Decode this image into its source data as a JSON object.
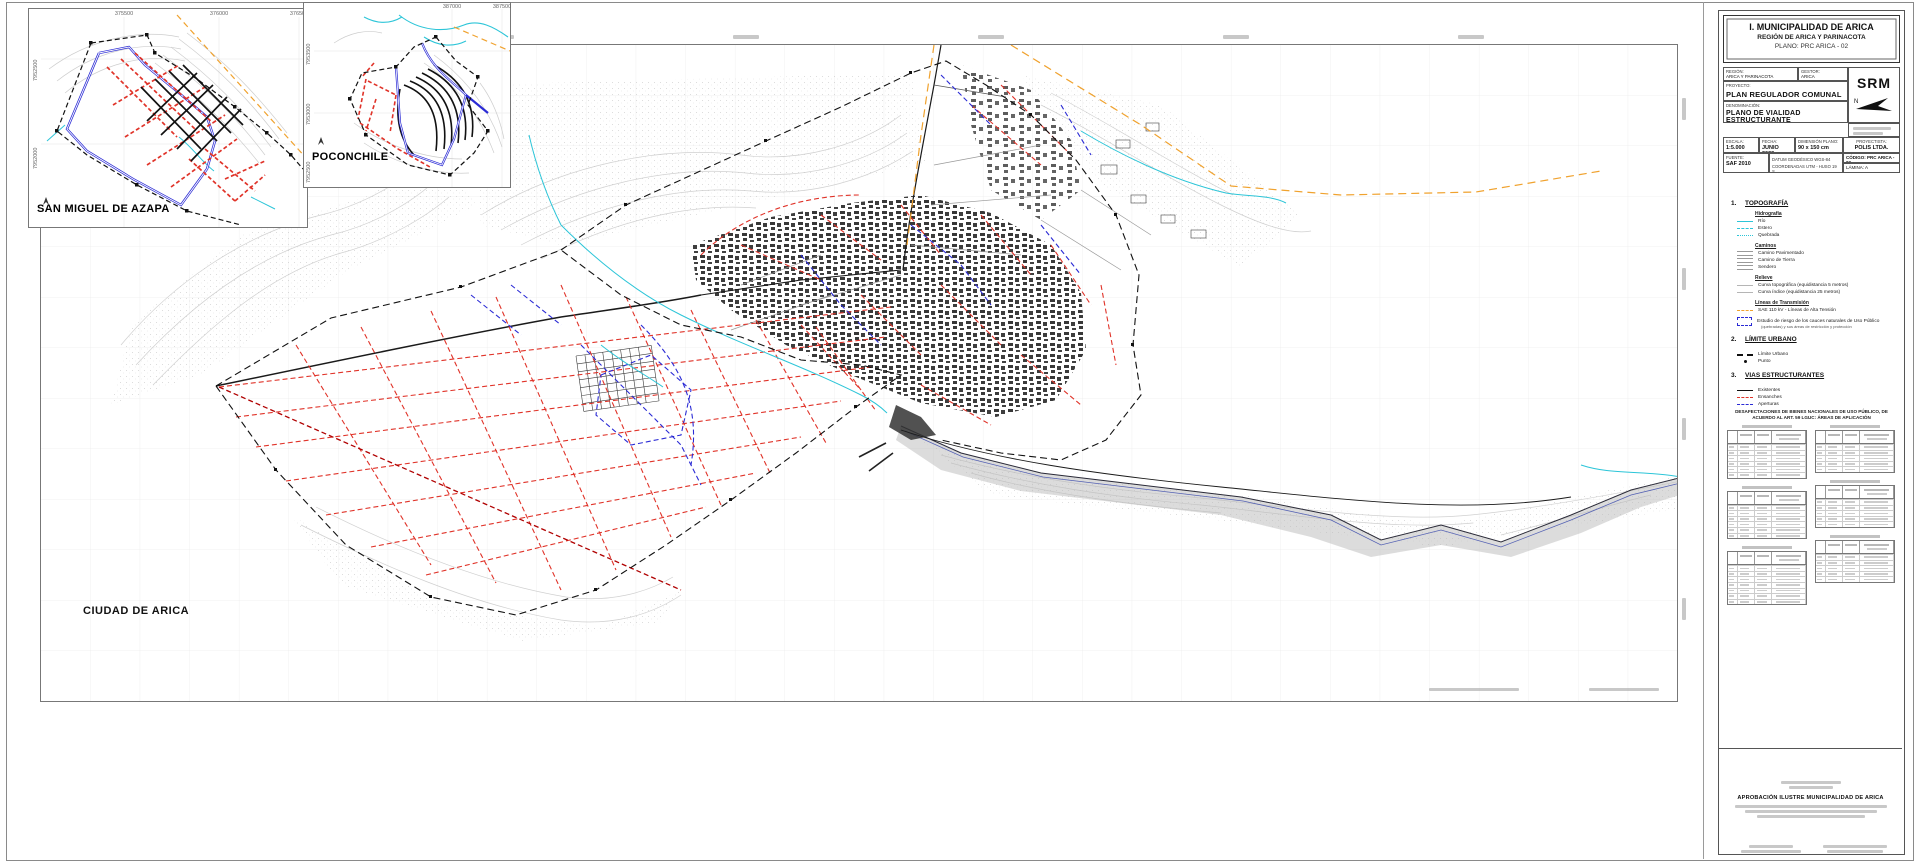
{
  "document": {
    "map_label": "CIUDAD DE ARICA",
    "insets": {
      "san_miguel": {
        "title": "SAN MIGUEL DE AZAPA",
        "x_labels": [
          "375500",
          "376000",
          "376500"
        ],
        "y_labels": [
          "7952500",
          "7952000"
        ]
      },
      "poconchile": {
        "title": "POCONCHILE",
        "x_labels": [
          "387000",
          "387500"
        ],
        "y_labels": [
          "7953500",
          "7953000",
          "7952500"
        ]
      }
    }
  },
  "title_block": {
    "org": "I. MUNICIPALIDAD DE ARICA",
    "region_line": "REGIÓN DE ARICA Y PARINACOTA",
    "plano_line": "PLANO: PRC ARICA - 02",
    "region_cell_label": "REGIÓN:",
    "region_cell": "ARICA Y PARINACOTA",
    "gestor_cell_label": "GESTOR:",
    "gestor_cell": "ARICA",
    "proyecto_label": "PROYECTO:",
    "proyecto": "PLAN REGULADOR COMUNAL DE ARICA",
    "denominacion_label": "DENOMINACIÓN:",
    "denominacion": "PLANO DE VIALIDAD ESTRUCTURANTE",
    "logo_text": "SRM",
    "escala_label": "ESCALA:",
    "escala": "1:5.000",
    "fecha_label": "FECHA:",
    "fecha": "JUNIO 2022",
    "dimension_label": "DIMENSIÓN PLANO:",
    "dimension": "90 x 150 cm",
    "proyectista_label": "PROYECTISTA:",
    "proyectista": "POLIS LTDA.",
    "fuente_label": "FUENTE:",
    "fuente": "SAF 2010",
    "datum_line1": "DATUM GEODÉSICO WGS-84",
    "datum_line2": "COORDENADAS UTM - HUSO 19 S",
    "codigo": "CÓDIGO: PRC ARICA - 02",
    "lamina": "LÁMINA: A"
  },
  "legend": {
    "sections": [
      {
        "num": "1.",
        "title": "TOPOGRAFÍA",
        "groups": [
          {
            "header": "Hidrografía",
            "items": [
              {
                "swatch": "cyan-solid",
                "label": "Río"
              },
              {
                "swatch": "cyan-dash",
                "label": "Estero"
              },
              {
                "swatch": "cyan-dot",
                "label": "Quebrada"
              }
            ]
          },
          {
            "header": "Caminos",
            "items": [
              {
                "swatch": "road",
                "label": "Camino Pavimentado"
              },
              {
                "swatch": "road",
                "label": "Camino de Tierra"
              },
              {
                "swatch": "road",
                "label": "Sendero"
              }
            ]
          },
          {
            "header": "Relieve",
            "items": [
              {
                "swatch": "gray-thin",
                "label": "Curva topográfica (equidistancia 5 metros)"
              },
              {
                "swatch": "gray-thin",
                "label": "Curva índice (equidistancia 25 metros)"
              }
            ]
          },
          {
            "header": "Líneas de Transmisión",
            "items": [
              {
                "swatch": "orange-dash",
                "label": "SAE 110 kV - Líneas de Alta Tensión"
              }
            ]
          },
          {
            "header": null,
            "items": [
              {
                "swatch": "blue-rect",
                "label": "Estudio de riesgo de los cauces naturales de Uso Público",
                "sub": "(quebradas) y sus áreas de restricción y protección"
              }
            ]
          }
        ]
      },
      {
        "num": "2.",
        "title": "LÍMITE URBANO",
        "groups": [
          {
            "header": null,
            "items": [
              {
                "swatch": "limit",
                "label": "Límite Urbano"
              },
              {
                "swatch": "dot",
                "label": "Punto"
              }
            ]
          }
        ]
      },
      {
        "num": "3.",
        "title": "VIAS ESTRUCTURANTES",
        "groups": [
          {
            "header": null,
            "items": [
              {
                "swatch": "black-solid",
                "label": "Existentes"
              },
              {
                "swatch": "red-dash",
                "label": "Ensanches"
              },
              {
                "swatch": "blue-dash",
                "label": "Aperturas"
              }
            ]
          }
        ]
      }
    ]
  },
  "tables": {
    "title_line1": "DESAFECTACIONES DE BIENES NACIONALES DE USO PÚBLICO, DE",
    "title_line2": "ACUERDO AL ART. 59 LGUC: ÁREAS DE APLICACIÓN",
    "items": [
      {
        "col": "left",
        "rows": 6
      },
      {
        "col": "left",
        "rows": 6
      },
      {
        "col": "left",
        "rows": 7
      },
      {
        "col": "right",
        "rows": 5
      },
      {
        "col": "right",
        "rows": 5
      },
      {
        "col": "right",
        "rows": 5
      }
    ]
  },
  "approval": {
    "title": "APROBACIÓN ILUSTRE MUNICIPALIDAD DE ARICA"
  }
}
